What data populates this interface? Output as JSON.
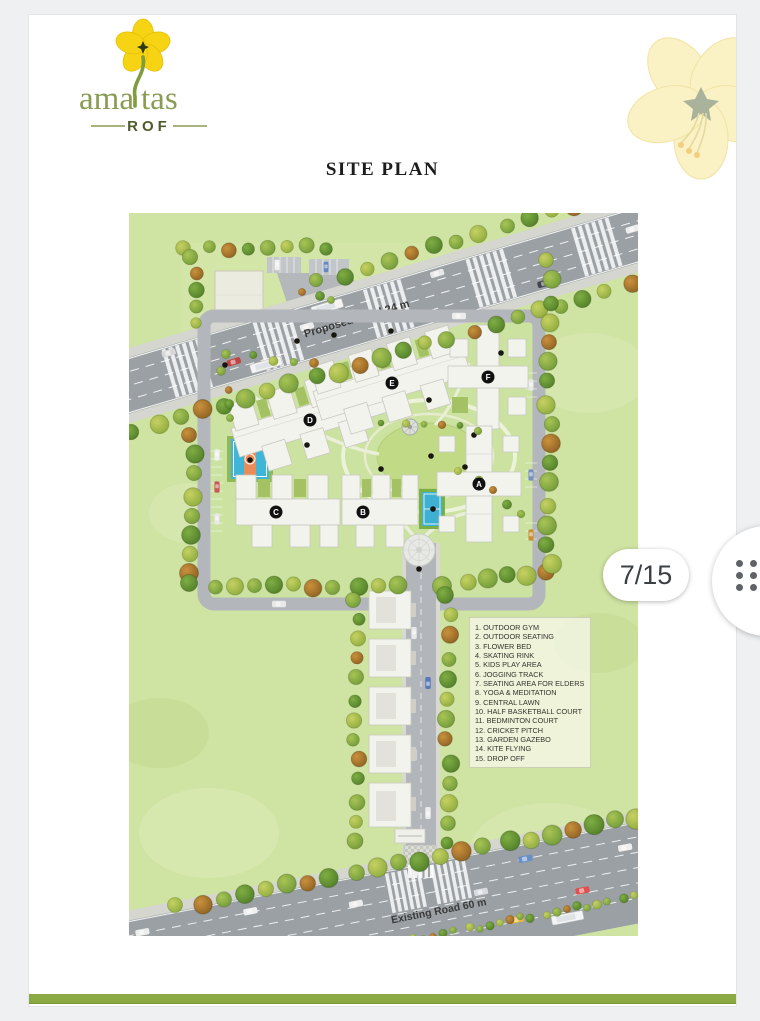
{
  "viewer": {
    "page_indicator": "7/15",
    "menu_icon": "drag-handle-dots-icon"
  },
  "document": {
    "title": "SITE PLAN",
    "brand": {
      "name_left": "ama",
      "name_right": "tas",
      "tagline": "ROF",
      "flower_color": "#f6d413",
      "text_color": "#8a9c54",
      "tagline_color": "#4e5c2c"
    },
    "footer_bar_color": "#8ba942"
  },
  "site_plan": {
    "roads": {
      "top_label": "Proposed Road 24 m",
      "bottom_label": "Existing Road 60 m"
    },
    "building_labels": [
      "A",
      "B",
      "C",
      "D",
      "E",
      "F"
    ],
    "legend": {
      "items": [
        "1. OUTDOOR GYM",
        "2. OUTDOOR SEATING",
        "3. FLOWER BED",
        "4. SKATING RINK",
        "5. KIDS PLAY AREA",
        "6. JOGGING TRACK",
        "7. SEATING AREA FOR ELDERS",
        "8. YOGA & MEDITATION",
        "9. CENTRAL LAWN",
        "10. HALF BASKETBALL COURT",
        "11. BEDMINTON COURT",
        "12. CRICKET PITCH",
        "13. GARDEN GAZEBO",
        "14. KITE FLYING",
        "15. DROP OFF"
      ]
    },
    "colors": {
      "ground_green": "#cfe3a3",
      "road_gray": "#9aa0a4",
      "court_blue": "#3fb5d7",
      "court_orange": "#e98c59",
      "tree_green": "#6d9737",
      "building_white": "#f3f3ee"
    }
  }
}
